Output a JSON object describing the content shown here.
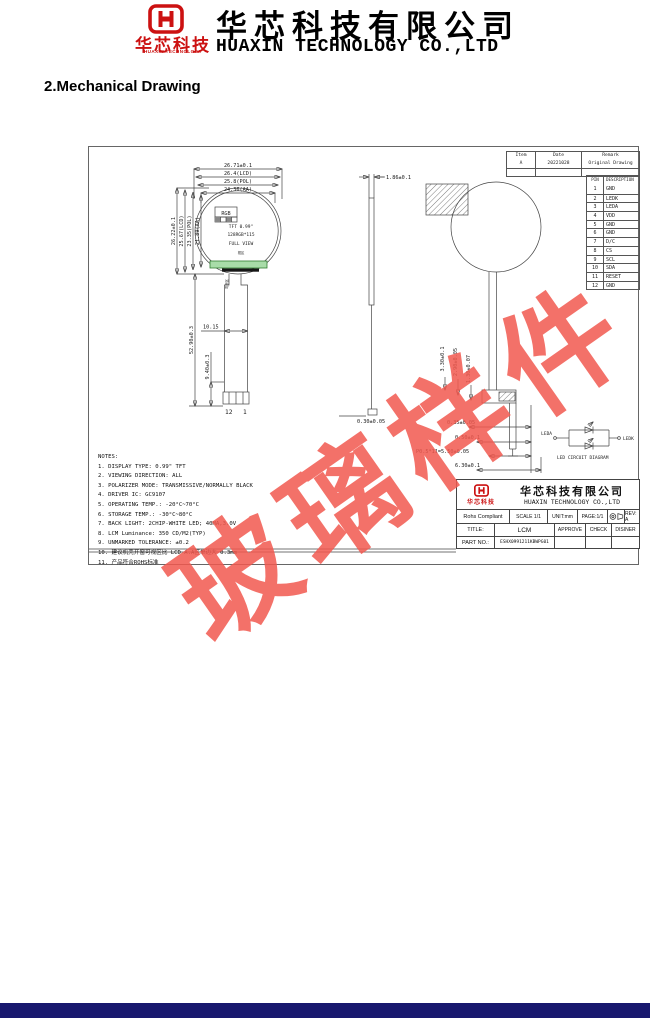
{
  "header": {
    "logo_text_cn": "华芯科技",
    "logo_text_en": "HUAXIN TECHNOLOGY",
    "company_cn": "华芯科技有限公司",
    "company_en": "HUAXIN TECHNOLOGY CO.,LTD"
  },
  "section_title": "2.Mechanical Drawing",
  "watermark_text": "玻璃样件",
  "revision_table": {
    "headers": [
      "Item",
      "Date",
      "Remark"
    ],
    "rows": [
      [
        "A",
        "20221028",
        "Original Drawing"
      ],
      [
        "",
        "",
        ""
      ]
    ]
  },
  "pin_table": {
    "headers": [
      "PIN",
      "DESCRIPTION"
    ],
    "rows": [
      [
        "1",
        "GND"
      ],
      [
        "2",
        "LEDK"
      ],
      [
        "3",
        "LEDA"
      ],
      [
        "4",
        "VDD"
      ],
      [
        "5",
        "GND"
      ],
      [
        "6",
        "GND"
      ],
      [
        "7",
        "D/C"
      ],
      [
        "8",
        "CS"
      ],
      [
        "9",
        "SCL"
      ],
      [
        "10",
        "SDA"
      ],
      [
        "11",
        "RESET"
      ],
      [
        "12",
        "GND"
      ]
    ]
  },
  "front_view": {
    "dims_top": [
      "26.71±0.1",
      "26.4(LCD)",
      "25.8(POL)",
      "24.36(AA)"
    ],
    "dims_left": [
      "26.22±0.1",
      "25.67(LCD)",
      "23.35(POL)",
      "21.89(AA)"
    ],
    "rgb_label": "RGB",
    "screen_line1": "TFT 0.99\"",
    "screen_line2": "128RGB*115",
    "screen_line3": "FULL VIEW",
    "screen_line4": "视区",
    "fpc_note": "弯折区",
    "dim_tail_width": "10.15",
    "dim_tail_length": "52.90±0.3",
    "dim_connector": "9.40±0.3",
    "pin_first": "12",
    "pin_last": "1"
  },
  "side_view": {
    "dim_thickness": "1.86±0.1",
    "dim_foot": "0.30±0.05"
  },
  "back_view": {
    "dim_v1": "3.30±0.1",
    "dim_v2": "2.90±0.05",
    "dim_v3": "1.30±0.07",
    "dim_b1": "0.35±0.05",
    "dim_b2": "0.50±0.1",
    "dim_b3": "P0.5*11=5.50±0.05",
    "dim_b4": "6.30±0.1"
  },
  "led_circuit": {
    "label_left": "LEDA",
    "label_right": "LEDK",
    "caption": "LED CIRCUIT DIAGRAM"
  },
  "notes": {
    "title": "NOTES:",
    "items": [
      "1. DISPLAY TYPE:   0.99\" TFT",
      "2. VIEWING DIRECTION: ALL",
      "3. POLARIZER MODE:  TRANSMISSIVE/NORMALLY BLACK",
      "4. DRIVER IC:       GC9107",
      "5. OPERATING TEMP.:   -20°C~70°C",
      "6. STORAGE TEMP.:   -30°C~80°C",
      "7. BACK LIGHT: 2CHIP-WHITE LED; 40MA,3.0V",
      "8. LCM Luminance: 350 CD/M2(TYP)",
      "9. UNMARKED TOLERANCE: ±0.2",
      "10. 建议机壳开窗可视区比 LCD A.A区单边大 0.3mm",
      "11. 产品符合ROHS标准"
    ]
  },
  "title_block": {
    "logo_text_cn": "华芯科技",
    "company_cn": "华芯科技有限公司",
    "company_en": "HUAXIN TECHNOLOGY CO.,LTD",
    "rohs": "Rohs Compliant",
    "scale": "SCALE 1/1",
    "unit": "UNIT:mm",
    "page": "PAGE:1/1",
    "rev": "REV: A",
    "title_label": "TITLE:",
    "title_value": "LCM",
    "approve": "APPROVE",
    "check": "CHECK",
    "designer": "DISINER",
    "partno_label": "PART NO.:",
    "partno_value": "ESHX0991211KBWPG01"
  },
  "colors": {
    "brand_red": "#cc1111",
    "watermark_red": "#f2594f",
    "footer_navy": "#18186e",
    "line_gray": "#444444",
    "green_strip": "#a8dca8"
  }
}
